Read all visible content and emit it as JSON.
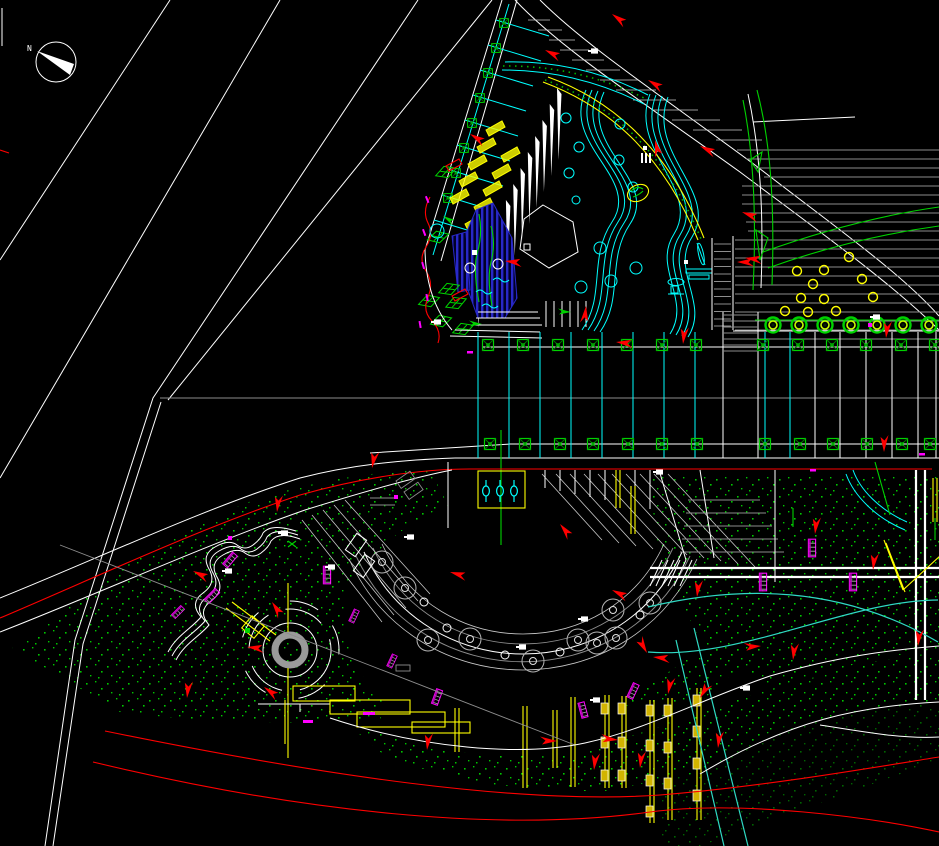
{
  "window": {
    "title": "Landscape site plan - CAD model space",
    "background": "#000000",
    "width": 939,
    "height": 846
  },
  "compass": {
    "label": "N"
  },
  "palette": {
    "white": "#ffffff",
    "gray": "#8d8d8d",
    "red": "#ff0000",
    "dark_red": "#b00000",
    "yellow": "#ffff00",
    "cyan": "#00ffff",
    "turquoise": "#2fd9c3",
    "green": "#00d200",
    "dark_green": "#00b400",
    "blue": "#2828c8",
    "magenta": "#ff00ff"
  },
  "layers": [
    {
      "name": "roads-and-curbs",
      "color": "#ffffff"
    },
    {
      "name": "paving-hatch",
      "color": "#8d8d8d"
    },
    {
      "name": "flow-arrows-and-road-edges",
      "color": "#ff0000"
    },
    {
      "name": "steps-walls-lighting",
      "color": "#ffff00"
    },
    {
      "name": "water-features-furniture",
      "color": "#00ffff"
    },
    {
      "name": "planting-and-grass",
      "color": "#00d200"
    },
    {
      "name": "pool-hatch",
      "color": "#2828c8"
    },
    {
      "name": "site-furniture-benches",
      "color": "#ff00ff"
    }
  ]
}
